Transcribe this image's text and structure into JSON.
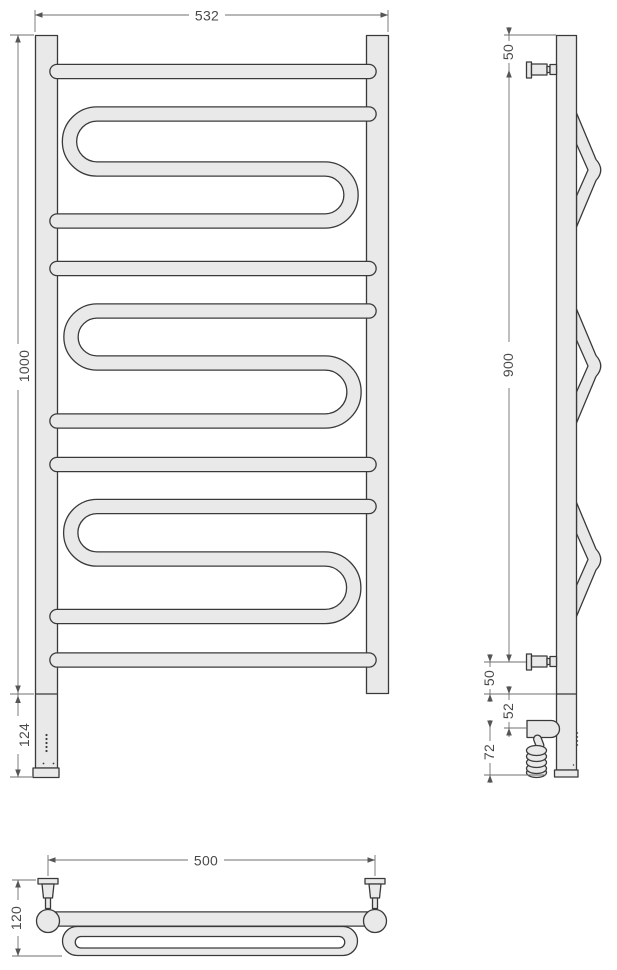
{
  "drawing": {
    "colors": {
      "part_fill": "#e9e9e9",
      "part_outline": "#3a3a3a",
      "dimension_line": "#6f6f6f",
      "dimension_text": "#4a4a4a",
      "background": "#ffffff"
    },
    "views": {
      "front": {
        "dims": {
          "width": "532",
          "height": "1000",
          "heater_height": "124"
        }
      },
      "side": {
        "dims": {
          "top_to_bracket": "50",
          "bracket_span": "900",
          "bracket_to_base": "50",
          "base_to_heater": "52",
          "heater_to_bottom": "72"
        }
      },
      "plan": {
        "dims": {
          "bracket_spacing": "500",
          "depth": "120"
        }
      }
    }
  }
}
